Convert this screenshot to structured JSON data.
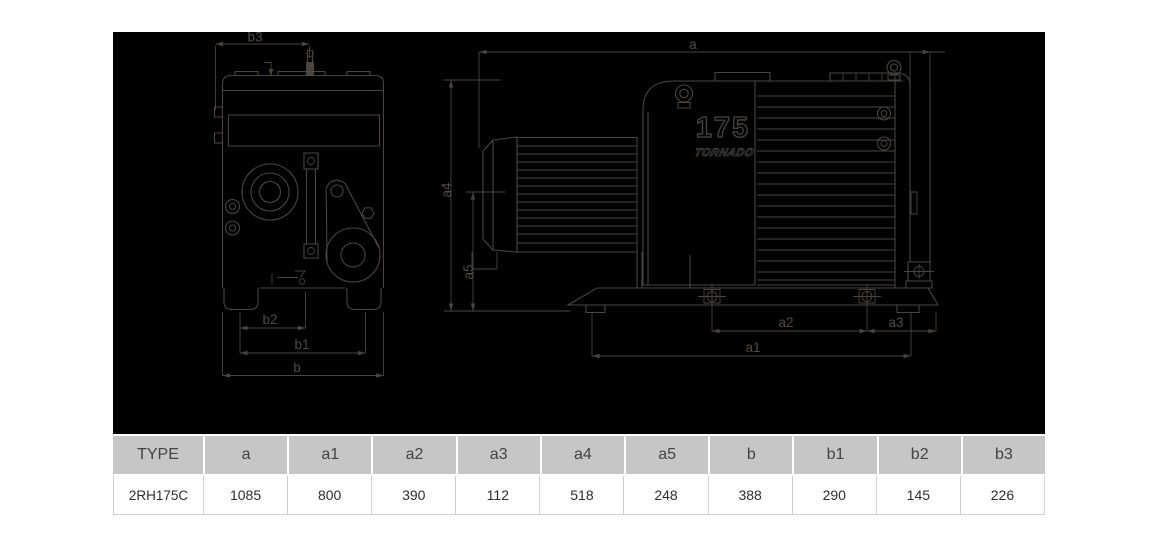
{
  "drawing": {
    "model_number": "175",
    "brand_text": "TORNADO",
    "background": "#000000",
    "line_color": "#4a443f",
    "dims": {
      "a": "a",
      "a1": "a1",
      "a2": "a2",
      "a3": "a3",
      "a4": "a4",
      "a5": "a5",
      "b": "b",
      "b1": "b1",
      "b2": "b2",
      "b3": "b3"
    }
  },
  "table": {
    "header_bg": "#c6c6c6",
    "headers": [
      "TYPE",
      "a",
      "a1",
      "a2",
      "a3",
      "a4",
      "a5",
      "b",
      "b1",
      "b2",
      "b3"
    ],
    "rows": [
      [
        "2RH175C",
        "1085",
        "800",
        "390",
        "112",
        "518",
        "248",
        "388",
        "290",
        "145",
        "226"
      ]
    ]
  }
}
